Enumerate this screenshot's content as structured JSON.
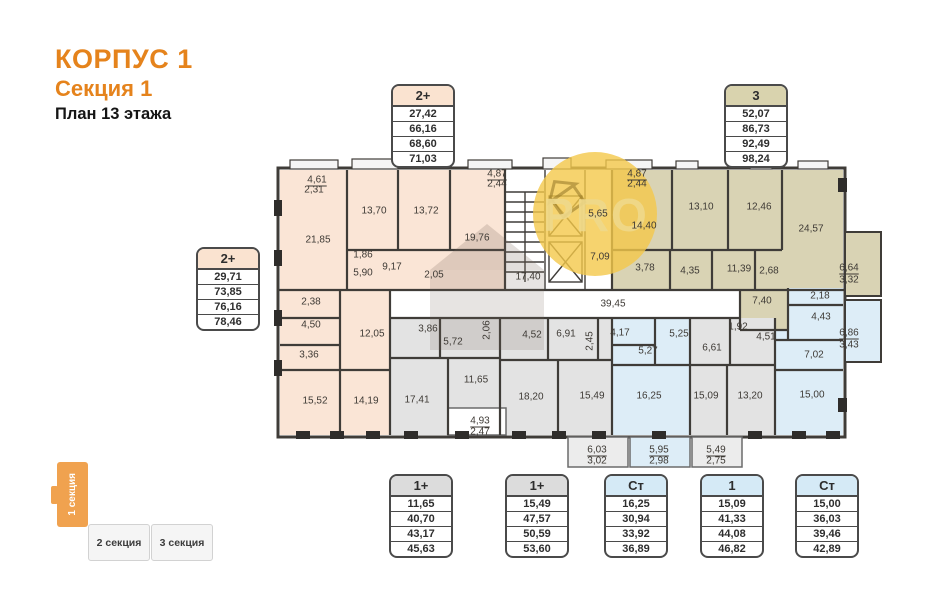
{
  "header": {
    "building_title": "КОРПУС 1",
    "section_title": "Секция 1",
    "floor_title": "План 13 этажа"
  },
  "watermark": {
    "text": "PRO"
  },
  "apartment_boxes": [
    {
      "type": "2+",
      "theme": "peach",
      "values": [
        "27,42",
        "66,16",
        "68,60",
        "71,03"
      ]
    },
    {
      "type": "3",
      "theme": "khaki",
      "values": [
        "52,07",
        "86,73",
        "92,49",
        "98,24"
      ]
    },
    {
      "type": "2+",
      "theme": "peach",
      "values": [
        "29,71",
        "73,85",
        "76,16",
        "78,46"
      ]
    },
    {
      "type": "1+",
      "theme": "gray",
      "values": [
        "11,65",
        "40,70",
        "43,17",
        "45,63"
      ]
    },
    {
      "type": "1+",
      "theme": "gray",
      "values": [
        "15,49",
        "47,57",
        "50,59",
        "53,60"
      ]
    },
    {
      "type": "Ст",
      "theme": "blue",
      "values": [
        "16,25",
        "30,94",
        "33,92",
        "36,89"
      ]
    },
    {
      "type": "1",
      "theme": "blue",
      "values": [
        "15,09",
        "41,33",
        "44,08",
        "46,82"
      ]
    },
    {
      "type": "Ст",
      "theme": "blue",
      "values": [
        "15,00",
        "36,03",
        "39,46",
        "42,89"
      ]
    }
  ],
  "section_nav": {
    "items": [
      {
        "label": "1 секция",
        "active": true
      },
      {
        "label": "2 секция",
        "active": false
      },
      {
        "label": "3 секция",
        "active": false
      }
    ]
  },
  "colors": {
    "accent_orange": "#e5831c",
    "nav_orange": "#f0a24f",
    "apartment_peach": "#fae5d6",
    "apartment_khaki": "#d9d3b4",
    "apartment_blue": "#ddedf7",
    "apartment_gray": "#e3e3e3",
    "wall": "#3f3c38",
    "watermark_yellow": "#f4c84a"
  },
  "plan": {
    "rooms": [
      {
        "t": "4,61",
        "x": 317,
        "y": 180,
        "u": 1
      },
      {
        "t": "2,31",
        "x": 314,
        "y": 190
      },
      {
        "t": "21,85",
        "x": 318,
        "y": 240
      },
      {
        "t": "13,70",
        "x": 374,
        "y": 211
      },
      {
        "t": "13,72",
        "x": 426,
        "y": 211
      },
      {
        "t": "19,76",
        "x": 477,
        "y": 238
      },
      {
        "t": "1,86",
        "x": 363,
        "y": 255
      },
      {
        "t": "5,90",
        "x": 363,
        "y": 273
      },
      {
        "t": "9,17",
        "x": 392,
        "y": 267
      },
      {
        "t": "2,05",
        "x": 434,
        "y": 275
      },
      {
        "t": "2,38",
        "x": 311,
        "y": 302
      },
      {
        "t": "4,50",
        "x": 311,
        "y": 325
      },
      {
        "t": "3,36",
        "x": 309,
        "y": 355
      },
      {
        "t": "12,05",
        "x": 372,
        "y": 334
      },
      {
        "t": "15,52",
        "x": 315,
        "y": 401
      },
      {
        "t": "14,19",
        "x": 366,
        "y": 401
      },
      {
        "t": "17,40",
        "x": 528,
        "y": 277
      },
      {
        "t": "5,65",
        "x": 598,
        "y": 214
      },
      {
        "t": "7,09",
        "x": 600,
        "y": 257
      },
      {
        "t": "39,45",
        "x": 613,
        "y": 304
      },
      {
        "t": "4,87",
        "x": 497,
        "y": 174,
        "u": 1
      },
      {
        "t": "2,44",
        "x": 497,
        "y": 184
      },
      {
        "t": "4,87",
        "x": 637,
        "y": 174,
        "u": 1
      },
      {
        "t": "2,44",
        "x": 637,
        "y": 184
      },
      {
        "t": "14,40",
        "x": 644,
        "y": 226
      },
      {
        "t": "13,10",
        "x": 701,
        "y": 207
      },
      {
        "t": "12,46",
        "x": 759,
        "y": 207
      },
      {
        "t": "24,57",
        "x": 811,
        "y": 229
      },
      {
        "t": "3,78",
        "x": 645,
        "y": 268
      },
      {
        "t": "4,35",
        "x": 690,
        "y": 271
      },
      {
        "t": "11,39",
        "x": 739,
        "y": 269
      },
      {
        "t": "2,68",
        "x": 769,
        "y": 271
      },
      {
        "t": "6,64",
        "x": 849,
        "y": 268,
        "u": 1
      },
      {
        "t": "3,32",
        "x": 849,
        "y": 280
      },
      {
        "t": "7,40",
        "x": 762,
        "y": 301
      },
      {
        "t": "2,18",
        "x": 820,
        "y": 296
      },
      {
        "t": "4,43",
        "x": 821,
        "y": 317
      },
      {
        "t": "4,17",
        "x": 620,
        "y": 333
      },
      {
        "t": "5,27",
        "x": 648,
        "y": 351
      },
      {
        "t": "5,25",
        "x": 679,
        "y": 334
      },
      {
        "t": "16,25",
        "x": 649,
        "y": 396
      },
      {
        "t": "7,02",
        "x": 814,
        "y": 355
      },
      {
        "t": "15,00",
        "x": 812,
        "y": 395
      },
      {
        "t": "6,86",
        "x": 849,
        "y": 333,
        "u": 1
      },
      {
        "t": "3,43",
        "x": 849,
        "y": 345
      },
      {
        "t": "3,86",
        "x": 428,
        "y": 329
      },
      {
        "t": "5,72",
        "x": 453,
        "y": 342
      },
      {
        "t": "2,06",
        "x": 487,
        "y": 330,
        "r": -90
      },
      {
        "t": "4,52",
        "x": 532,
        "y": 335
      },
      {
        "t": "6,91",
        "x": 566,
        "y": 334
      },
      {
        "t": "2,45",
        "x": 590,
        "y": 341,
        "r": -90
      },
      {
        "t": "11,65",
        "x": 476,
        "y": 380
      },
      {
        "t": "17,41",
        "x": 417,
        "y": 400
      },
      {
        "t": "18,20",
        "x": 531,
        "y": 397
      },
      {
        "t": "15,49",
        "x": 592,
        "y": 396
      },
      {
        "t": "1,92",
        "x": 738,
        "y": 327
      },
      {
        "t": "4,51",
        "x": 766,
        "y": 337
      },
      {
        "t": "6,61",
        "x": 712,
        "y": 348
      },
      {
        "t": "15,09",
        "x": 706,
        "y": 396
      },
      {
        "t": "13,20",
        "x": 750,
        "y": 396
      },
      {
        "t": "4,93",
        "x": 480,
        "y": 421,
        "u": 1
      },
      {
        "t": "2,47",
        "x": 480,
        "y": 432
      },
      {
        "t": "6,03",
        "x": 597,
        "y": 450,
        "u": 1
      },
      {
        "t": "3,02",
        "x": 597,
        "y": 461
      },
      {
        "t": "5,95",
        "x": 659,
        "y": 450,
        "u": 1
      },
      {
        "t": "2,98",
        "x": 659,
        "y": 461
      },
      {
        "t": "5,49",
        "x": 716,
        "y": 450,
        "u": 1
      },
      {
        "t": "2,75",
        "x": 716,
        "y": 461
      }
    ]
  }
}
